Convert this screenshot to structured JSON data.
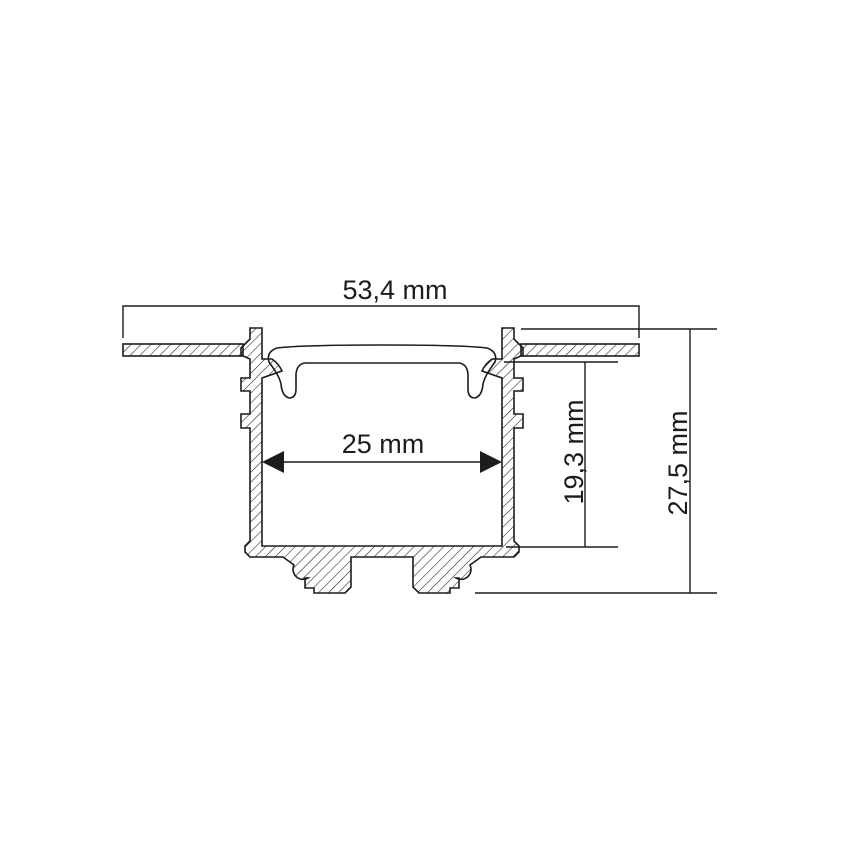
{
  "figure": {
    "background_color": "#ffffff",
    "line_color": "#1c1c1c",
    "dimensions": {
      "outer_width": "53,4 mm",
      "inner_width": "25 mm",
      "inner_depth": "19,3 mm",
      "total_height": "27,5 mm"
    }
  }
}
